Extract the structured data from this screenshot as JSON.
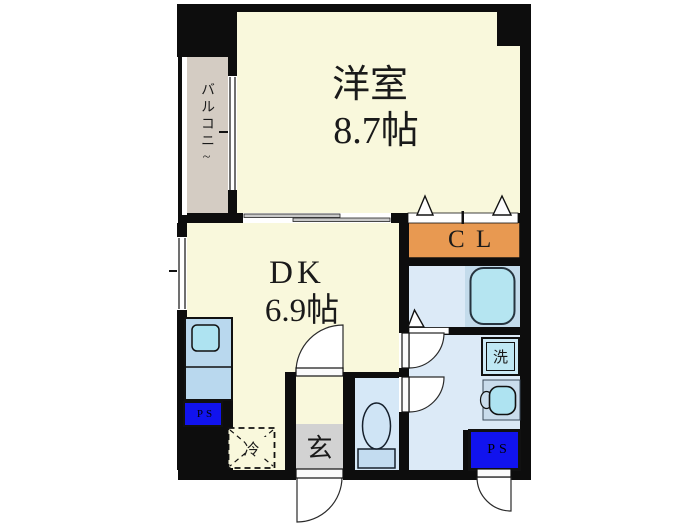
{
  "plan": {
    "western_room": {
      "label": "洋室",
      "size": "8.7帖"
    },
    "dining_kitchen": {
      "label": "DK",
      "size": "6.9帖"
    },
    "closet_label": "CL",
    "balcony_label": "バルコニ~",
    "entrance_label": "玄",
    "refrigerator_label": "冷",
    "washing_machine_label": "洗",
    "pipe_space_kitchen_label": "PS",
    "pipe_space_utility_label": "PS"
  },
  "colors": {
    "wall": "#0d0d0d",
    "room_floor": "#f9f8dc",
    "balcony_floor": "#d4ccc3",
    "closet": "#e89951",
    "wet_area_floor": "#dceaf7",
    "tub_surround": "#c3dbeb",
    "toilet_floor": "#d6e8f7",
    "kitchen_unit": "#b9d8ee",
    "fixture_cyan": "#aee3f1",
    "tub": "#b5e5f1",
    "pipe_space_blue": "#1113ee",
    "entrance_gray": "#d2d2d2"
  }
}
